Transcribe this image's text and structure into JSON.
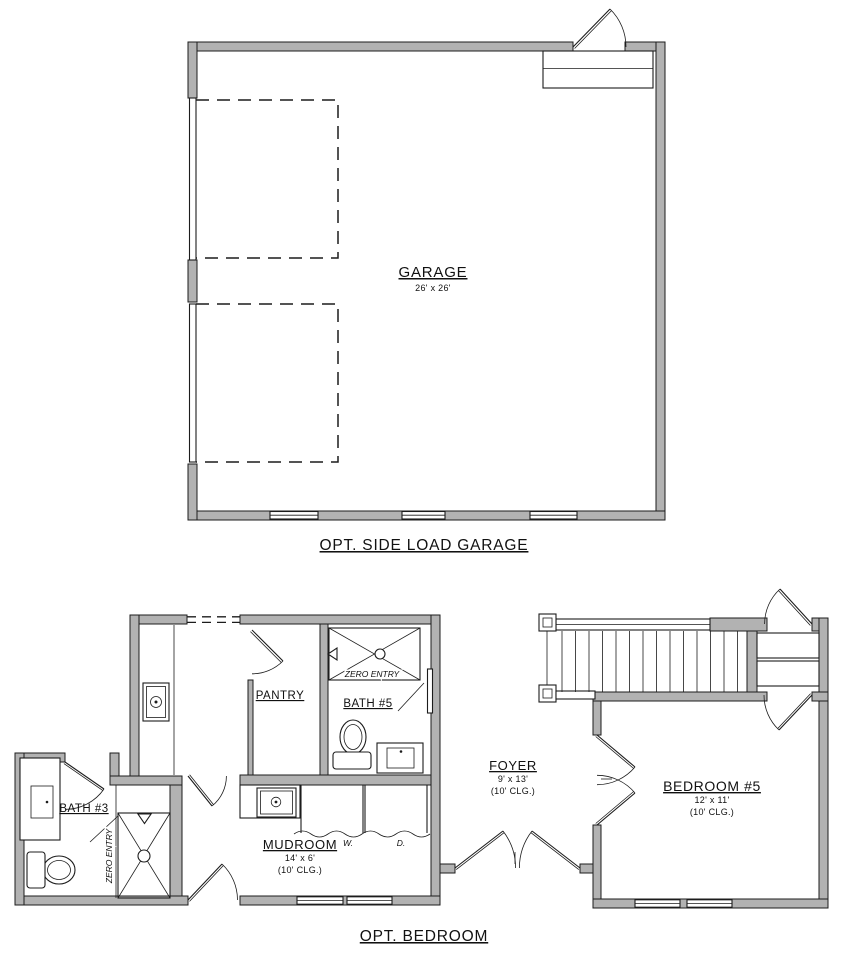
{
  "document": {
    "type": "architectural-floor-plan",
    "background": "#ffffff"
  },
  "colors": {
    "wall_fill": "#b2b2b2",
    "line": "#1c1c1c"
  },
  "garage_plan": {
    "room_label": "GARAGE",
    "room_dims": "26' x 26'",
    "caption": "OPT. SIDE LOAD GARAGE"
  },
  "bedroom_plan": {
    "caption": "OPT. BEDROOM",
    "pantry_label": "PANTRY",
    "bath5_label": "BATH #5",
    "bath5_shower_label": "ZERO ENTRY",
    "bath3_label": "BATH #3",
    "bath3_shower_label": "ZERO ENTRY",
    "mudroom_label": "MUDROOM",
    "mudroom_dims": "14' x 6'",
    "mudroom_ceiling": "(10' CLG.)",
    "foyer_label": "FOYER",
    "foyer_dims": "9' x 13'",
    "foyer_ceiling": "(10' CLG.)",
    "bedroom5_label": "BEDROOM #5",
    "bedroom5_dims": "12' x 11'",
    "bedroom5_ceiling": "(10' CLG.)",
    "washer_label": "W.",
    "dryer_label": "D."
  }
}
